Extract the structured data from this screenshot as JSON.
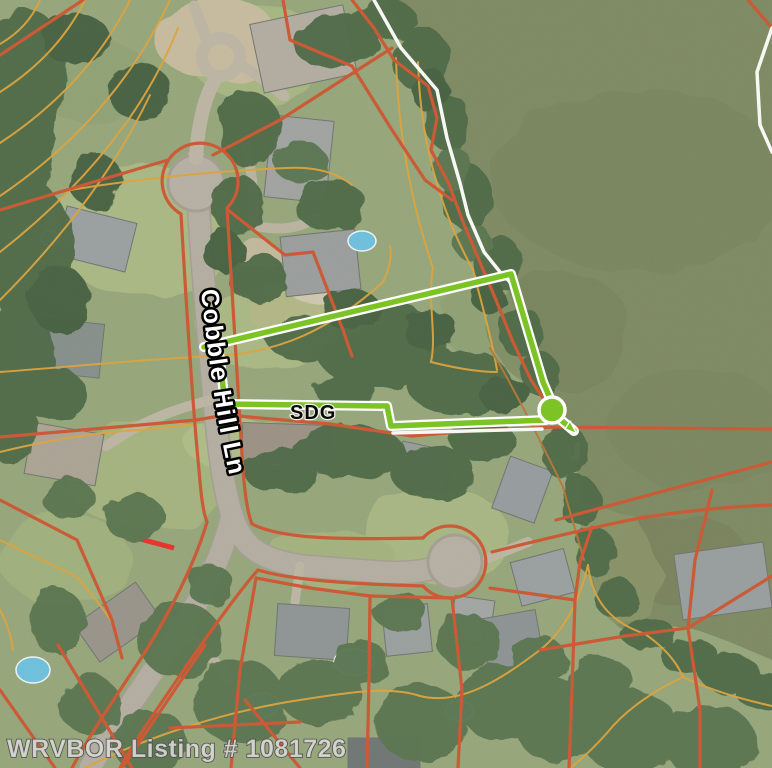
{
  "labels": {
    "street": "Cobble Hill Ln",
    "parcel_code": "SDG"
  },
  "watermark": {
    "text": "WRVBOR Listing # 1081726"
  },
  "marker": {
    "name": "selected-parcel-corner-marker",
    "shape": "circle"
  },
  "colors": {
    "selected_parcel_green": "#7cc325",
    "parcel_boundary_orange": "#cb5a36",
    "contour_tan": "#dca440",
    "contour_brown": "#b5793a",
    "plat_boundary_white": "#f7f7f4",
    "water_olive": "#7e8a62",
    "road_gray": "#b4aea1",
    "red_accent": "#e5332a",
    "pool_blue": "#6ec0dd"
  }
}
